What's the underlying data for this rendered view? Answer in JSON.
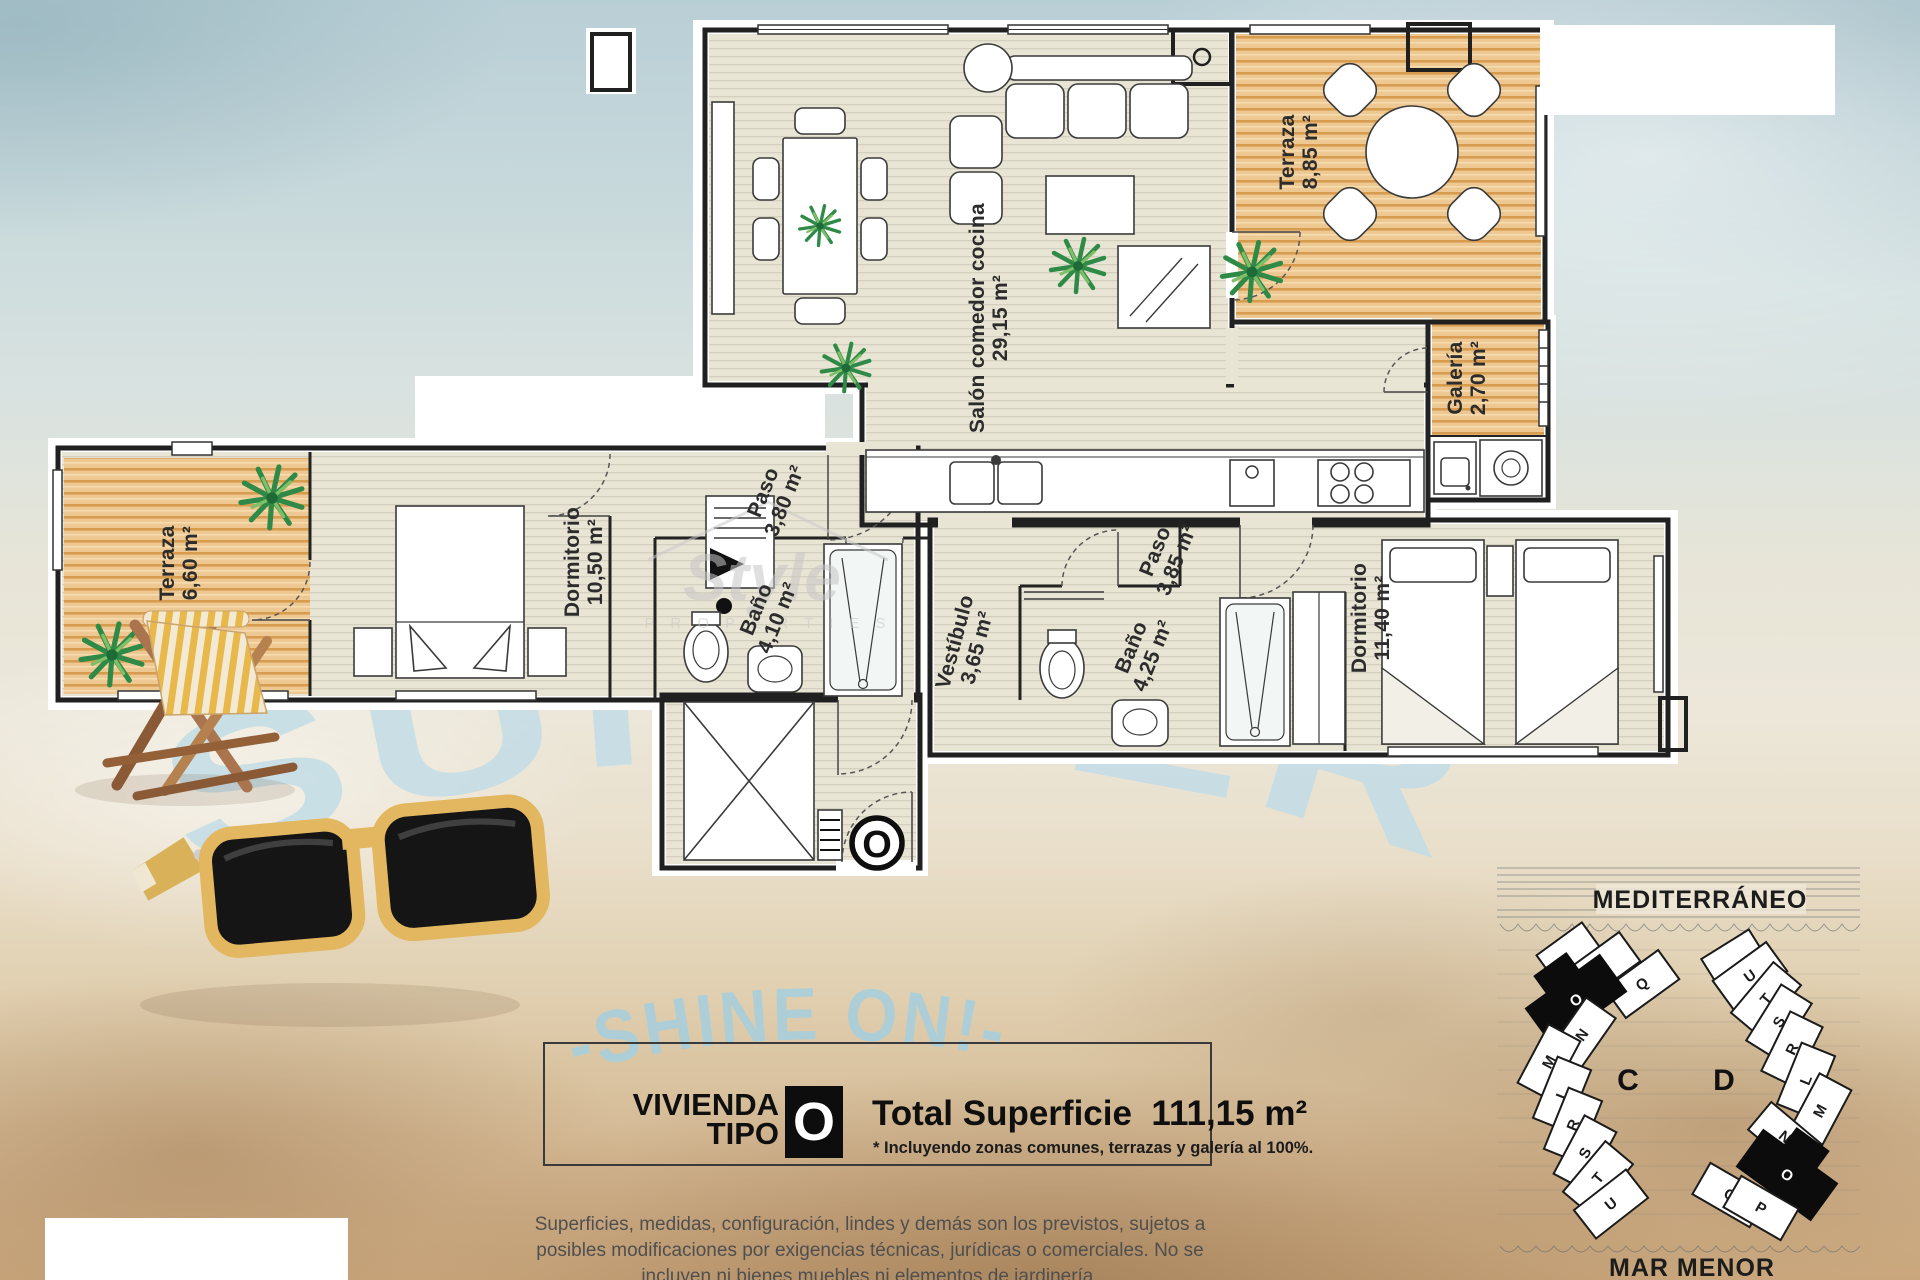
{
  "watermark": {
    "arc_text": "SUMMER",
    "sub_text": "-SHINE ON!-",
    "brand_script": "Style",
    "brand_caps": "P R O P E R T I E S"
  },
  "floorplan": {
    "rooms": {
      "terraza_main": {
        "name": "Terraza",
        "area": "8,85 m²"
      },
      "galeria": {
        "name": "Galería",
        "area": "2,70 m²"
      },
      "salon": {
        "name": "Salón comedor cocina",
        "area": "29,15 m²"
      },
      "terraza_left": {
        "name": "Terraza",
        "area": "6,60 m²"
      },
      "dormitorio_1": {
        "name": "Dormitorio",
        "area": "10,50 m²"
      },
      "paso_1": {
        "name": "Paso",
        "area": "3,80 m²"
      },
      "bano_1": {
        "name": "Baño",
        "area": "4,10 m²"
      },
      "vestibulo": {
        "name": "Vestíbulo",
        "area": "3,65 m²"
      },
      "paso_2": {
        "name": "Paso",
        "area": "3,85 m²"
      },
      "bano_2": {
        "name": "Baño",
        "area": "4,25 m²"
      },
      "dormitorio_2": {
        "name": "Dormitorio",
        "area": "11,40 m²"
      }
    },
    "entrance_marker": "O"
  },
  "info_box": {
    "line1": "VIVIENDA",
    "line2": "TIPO",
    "type_letter": "O",
    "total_label": "Total Superficie",
    "total_value": "111,15 m²",
    "footnote": "* Incluyendo zonas comunes, terrazas y galería al 100%."
  },
  "disclaimer": "Superficies, medidas, configuración, lindes y demás son los previstos, sujetos a posibles modificaciones por exigencias técnicas, jurídicas o comerciales. No se incluyen ni bienes muebles ni elementos de jardinería.",
  "site_plan": {
    "sea_label": "MEDITERRÁNEO",
    "shore_label": "MAR MENOR",
    "building_c": {
      "label": "C",
      "units": [
        "P",
        "Q",
        "O",
        "N",
        "M",
        "L",
        "R",
        "S",
        "T",
        "U"
      ],
      "highlighted_unit": "O"
    },
    "building_d": {
      "label": "D",
      "units": [
        "U",
        "T",
        "S",
        "R",
        "L",
        "M",
        "N",
        "O",
        "Q",
        "P"
      ],
      "highlighted_unit": "O"
    }
  },
  "colors": {
    "watermark_blue": "#c3dde7",
    "wood_deck": "#eec893",
    "wood_stripe": "#d89c4f",
    "floor_beige": "#e9e5d5",
    "highlight_black": "#0d0d0d",
    "sunglasses_yellow": "#e2b75f"
  }
}
